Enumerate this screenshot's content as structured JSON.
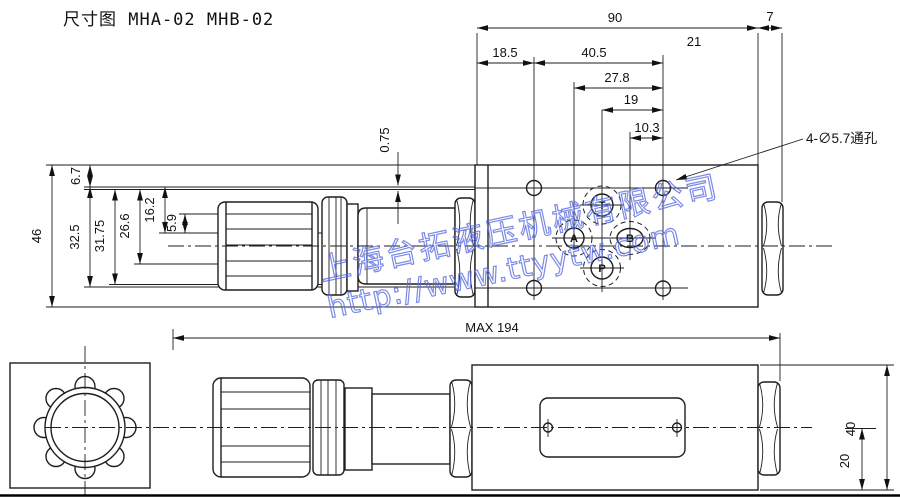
{
  "title": "尺寸图 MHA-02 MHB-02",
  "top_view": {
    "width_total": "90",
    "width_right": "7",
    "width_21": "21",
    "width_left_hole": "18.5",
    "width_40_5": "40.5",
    "width_27_8": "27.8",
    "width_19": "19",
    "width_10_3": "10.3",
    "height_total": "46",
    "height_6_7": "6.7",
    "height_32_5": "32.5",
    "height_31_75": "31.75",
    "height_26_6": "26.6",
    "height_16_2": "16.2",
    "height_5_9": "5.9",
    "surface_offset": "0.75",
    "hole_note": "4-∅5.7通孔",
    "port_t": "T",
    "port_a": "A",
    "port_b": "B",
    "port_p": "P"
  },
  "bottom_view": {
    "max_length": "MAX  194",
    "height_total": "40",
    "height_center": "20"
  },
  "watermark": {
    "company": "上海台拓液压机械有限公司",
    "url": "http://www.ttyytw.com",
    "color": "#5b6ee0"
  }
}
